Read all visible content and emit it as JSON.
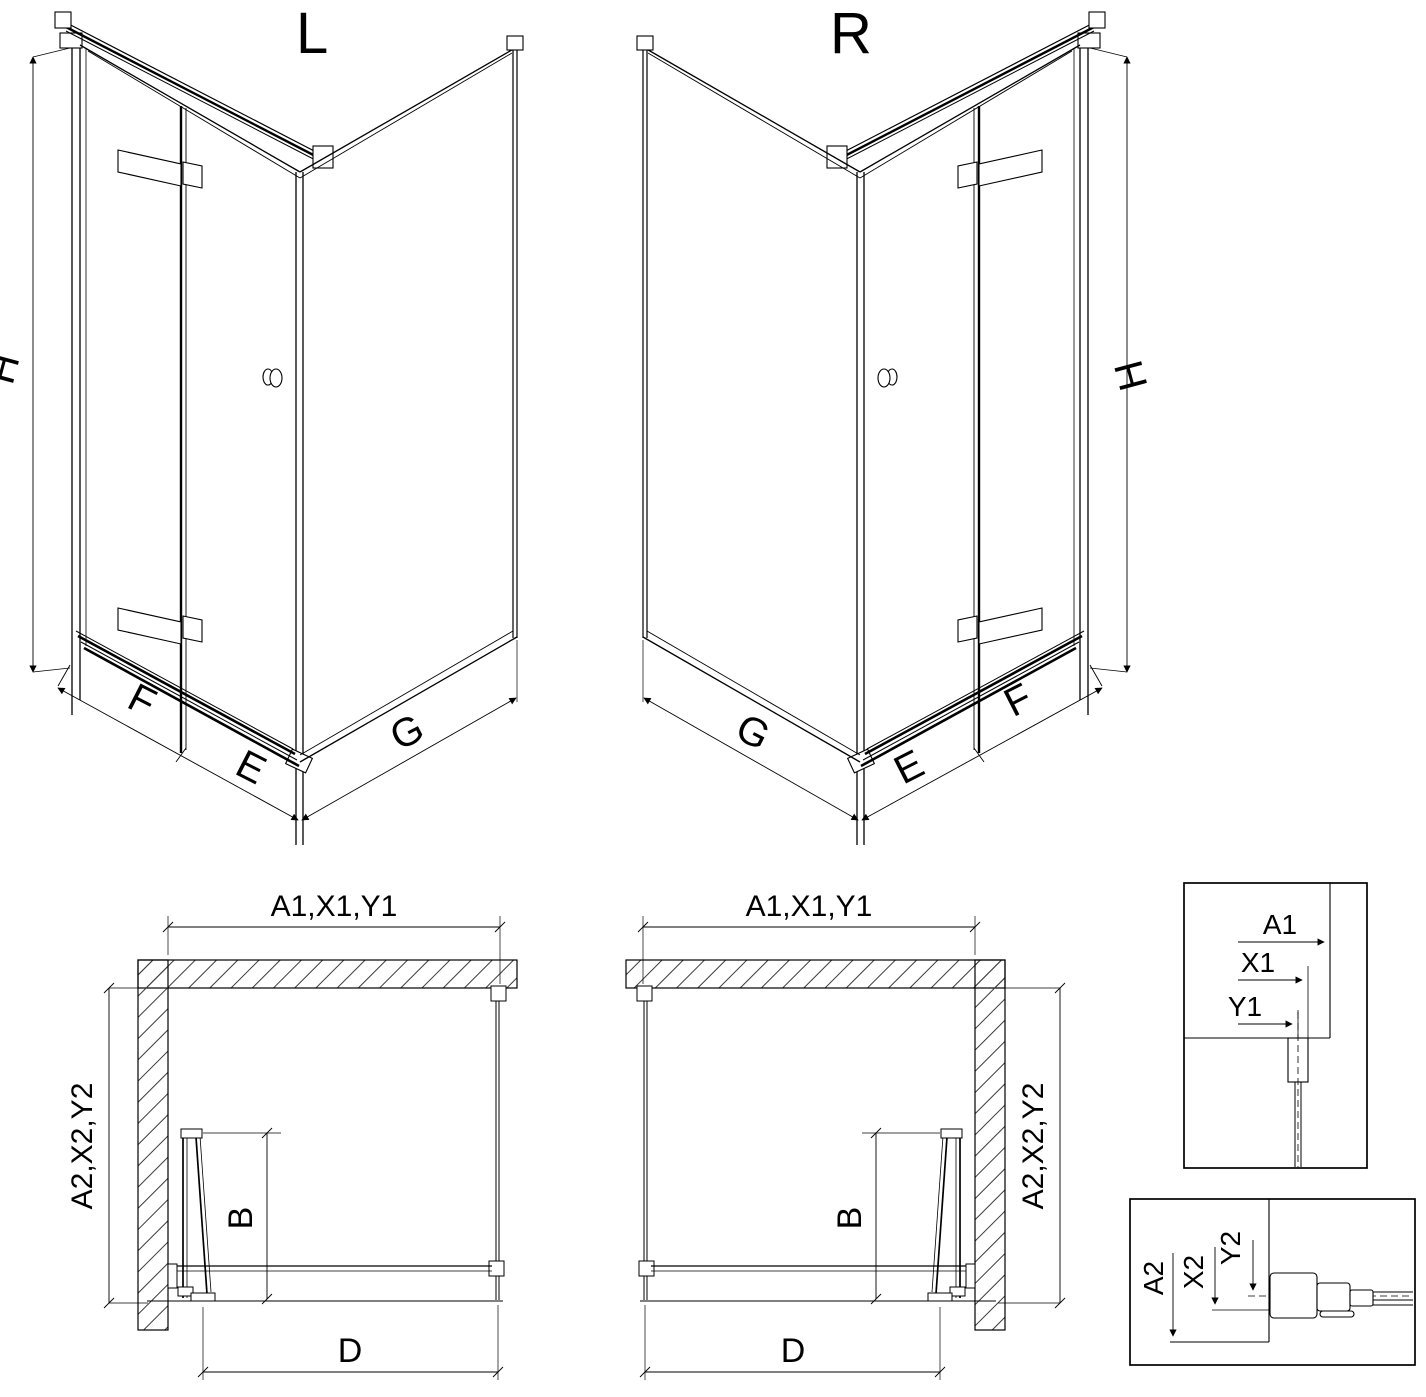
{
  "iso_left": {
    "label": "L",
    "dim_height": "H",
    "dim_fold_panel": "F",
    "dim_door_panel": "E",
    "dim_side_panel": "G"
  },
  "iso_right": {
    "label": "R",
    "dim_height": "H",
    "dim_fold_panel": "F",
    "dim_door_panel": "E",
    "dim_side_panel": "G"
  },
  "plan_left": {
    "dim_width": "A1,X1,Y1",
    "dim_depth": "A2,X2,Y2",
    "dim_door": "B",
    "dim_entry": "D"
  },
  "plan_right": {
    "dim_width": "A1,X1,Y1",
    "dim_depth": "A2,X2,Y2",
    "dim_door": "B",
    "dim_entry": "D"
  },
  "detail_width": {
    "dim_a": "A1",
    "dim_x": "X1",
    "dim_y": "Y1"
  },
  "detail_depth": {
    "dim_a": "A2",
    "dim_x": "X2",
    "dim_y": "Y2"
  }
}
